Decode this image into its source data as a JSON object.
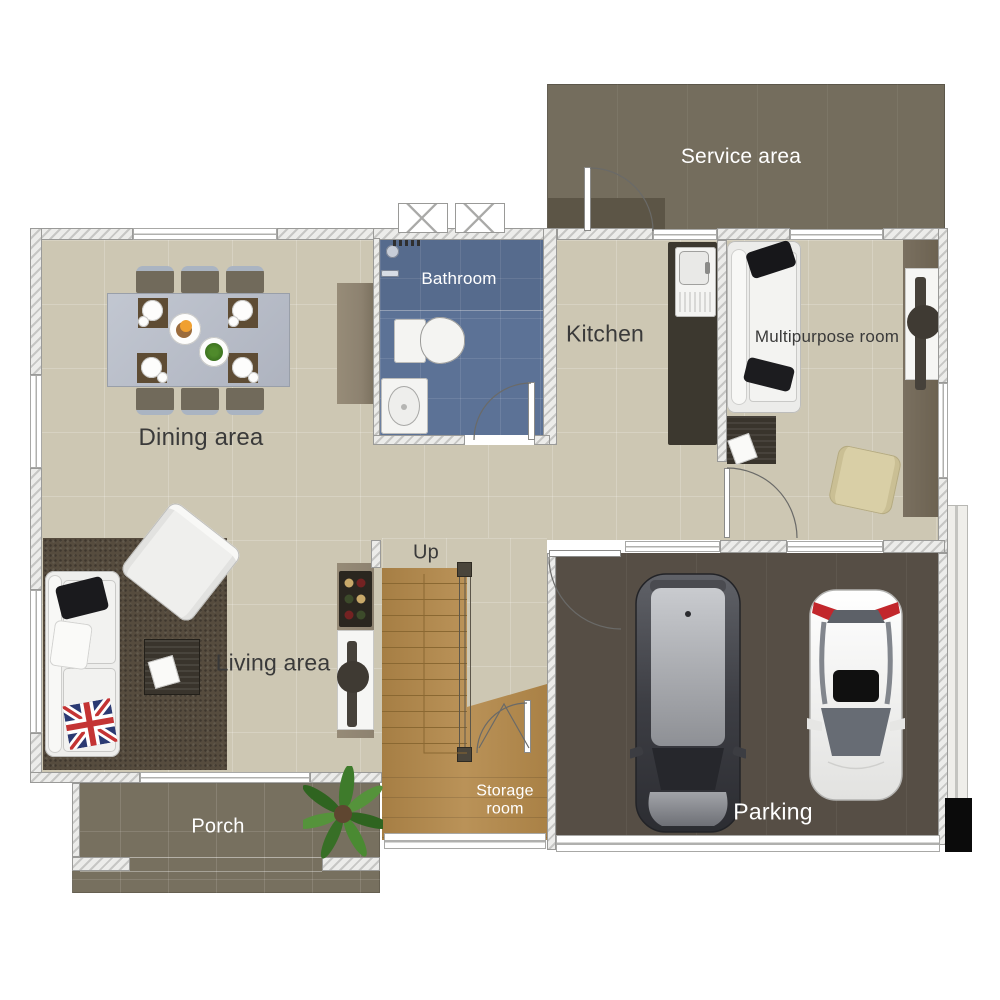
{
  "palette": {
    "floor": "#cdc7b3",
    "bathroom": "#5c7296",
    "service": "#746d5d",
    "service-dark": "#5c5546",
    "porch": "#77705f",
    "parking": "#564e45",
    "wood": "#b4894a",
    "wood-line": "#8a6832",
    "rug-living": "#564c3e",
    "rug-dark": "#39342c",
    "counter": "#3c382f",
    "closet": "#6c6251",
    "cabinet": "#8d8270",
    "table": "#b8bdc8",
    "chair": "#716a5b",
    "ink": "#3a3a3a"
  },
  "rooms": {
    "service": {
      "label": "Service area"
    },
    "bathroom": {
      "label": "Bathroom"
    },
    "kitchen": {
      "label": "Kitchen"
    },
    "multipurpose": {
      "label": "Multipurpose room"
    },
    "dining": {
      "label": "Dining area"
    },
    "living": {
      "label": "Living area"
    },
    "storage": {
      "label": "Storage room"
    },
    "porch": {
      "label": "Porch"
    },
    "parking": {
      "label": "Parking"
    }
  },
  "annotations": {
    "stairs_up": "Up"
  }
}
